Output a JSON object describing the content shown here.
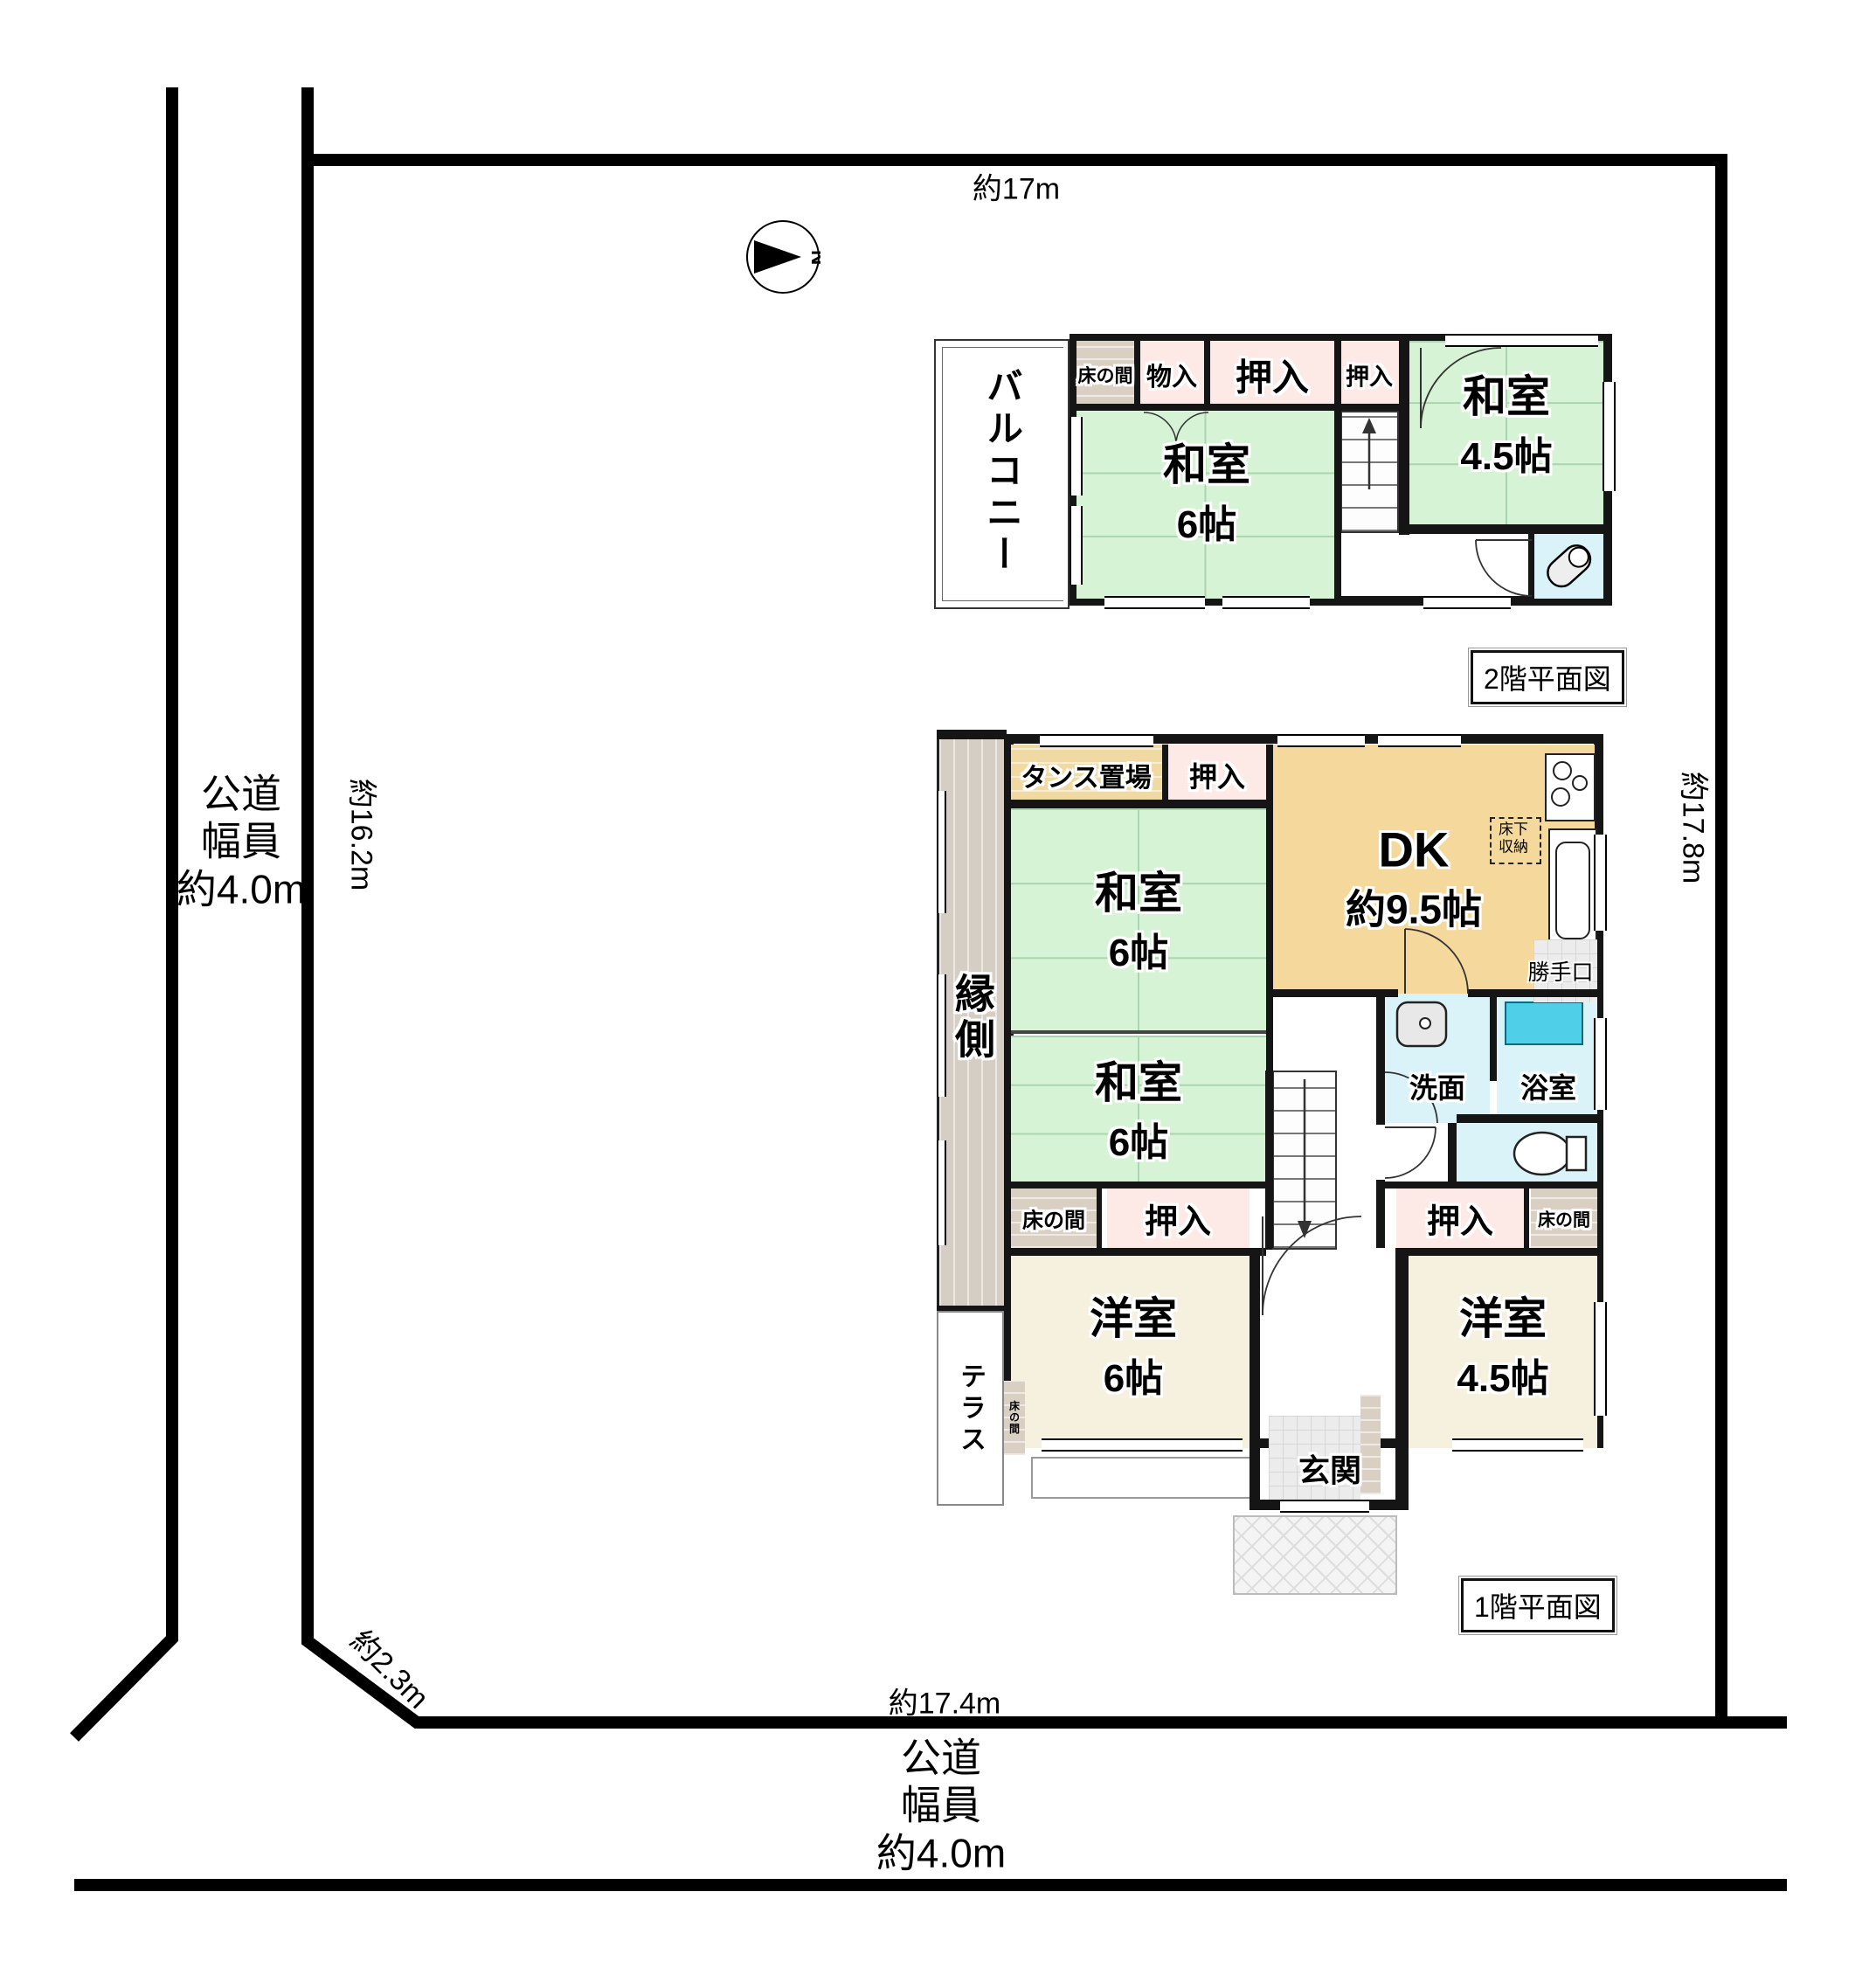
{
  "site": {
    "dim_top": "約17m",
    "dim_left": "約16.2m",
    "dim_right": "約17.8m",
    "dim_bottom": "約17.4m",
    "dim_corner": "約2.3m",
    "road_left": {
      "line1": "公道",
      "line2": "幅員",
      "line3": "約4.0m"
    },
    "road_bottom": {
      "line1": "公道",
      "line2": "幅員",
      "line3": "約4.0m"
    },
    "compass": "N"
  },
  "floor2": {
    "title": "2階平面図",
    "balcony": "バルコニー",
    "tokonoma": "床の間",
    "storage": "物入",
    "closet_large": "押入",
    "closet_small": "押入",
    "washitsu6": {
      "name": "和室",
      "size": "6帖"
    },
    "washitsu45": {
      "name": "和室",
      "size": "4.5帖"
    }
  },
  "floor1": {
    "title": "1階平面図",
    "tansu": "タンス置場",
    "closet_top": "押入",
    "dk": {
      "name": "DK",
      "size": "約9.5帖"
    },
    "underfloor": {
      "line1": "床下",
      "line2": "収納"
    },
    "backdoor": "勝手口",
    "engawa": "縁側",
    "washitsu6_upper": {
      "name": "和室",
      "size": "6帖"
    },
    "washitsu6_lower": {
      "name": "和室",
      "size": "6帖"
    },
    "senmen": "洗面",
    "bath": "浴室",
    "tokonoma_left": "床の間",
    "closet_left": "押入",
    "closet_right": "押入",
    "tokonoma_right": "床の間",
    "tokonoma_small": "床の間",
    "yoshitsu6": {
      "name": "洋室",
      "size": "6帖"
    },
    "yoshitsu45": {
      "name": "洋室",
      "size": "4.5帖"
    },
    "terrace": "テラス",
    "genkan": "玄関"
  },
  "colors": {
    "wall": "#151515",
    "tatami": "#d7f3d5",
    "tatami-line": "#a9d6ae",
    "closet": "#fdeae7",
    "tokonoma": "#dacfc3",
    "tansu": "#f0d9a2",
    "dk": "#f5d99c",
    "water": "#daf3f8",
    "tub": "#4fd0e8",
    "cream": "#f6f0df",
    "tile": "#ececec",
    "engawa": "#d6cdc4"
  }
}
